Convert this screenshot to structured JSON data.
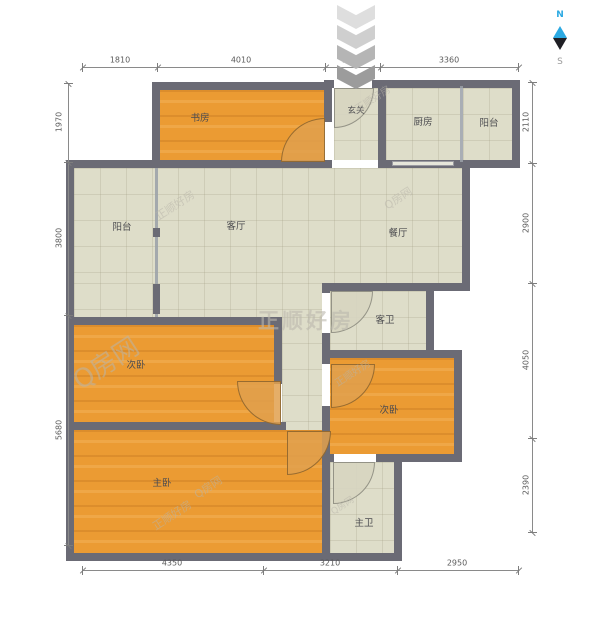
{
  "compass": {
    "north": "N",
    "south": "S",
    "north_color": "#2ba9e2"
  },
  "watermarks": {
    "brand": "正顺好房",
    "site": "Q房网"
  },
  "colors": {
    "wall": "#6b6b75",
    "wood_floor": "#eb9b33",
    "tile_floor": "#deddc9",
    "dimension": "#8a8a8a"
  },
  "rooms": {
    "study": {
      "label": "书房"
    },
    "entry": {
      "label": "玄关"
    },
    "kitchen": {
      "label": "厨房"
    },
    "balcony_top": {
      "label": "阳台"
    },
    "balcony_left": {
      "label": "阳台"
    },
    "living": {
      "label": "客厅"
    },
    "dining": {
      "label": "餐厅"
    },
    "guest_bath": {
      "label": "客卫"
    },
    "bedroom_left": {
      "label": "次卧"
    },
    "bedroom_right": {
      "label": "次卧"
    },
    "master": {
      "label": "主卧"
    },
    "master_bath": {
      "label": "主卫"
    }
  },
  "dimensions": {
    "top": [
      "1810",
      "4010",
      "1230",
      "3360"
    ],
    "bottom": [
      "4350",
      "3210",
      "2950"
    ],
    "left": [
      "1970",
      "3800",
      "5680"
    ],
    "right": [
      "2110",
      "2900",
      "4050",
      "2390"
    ]
  }
}
